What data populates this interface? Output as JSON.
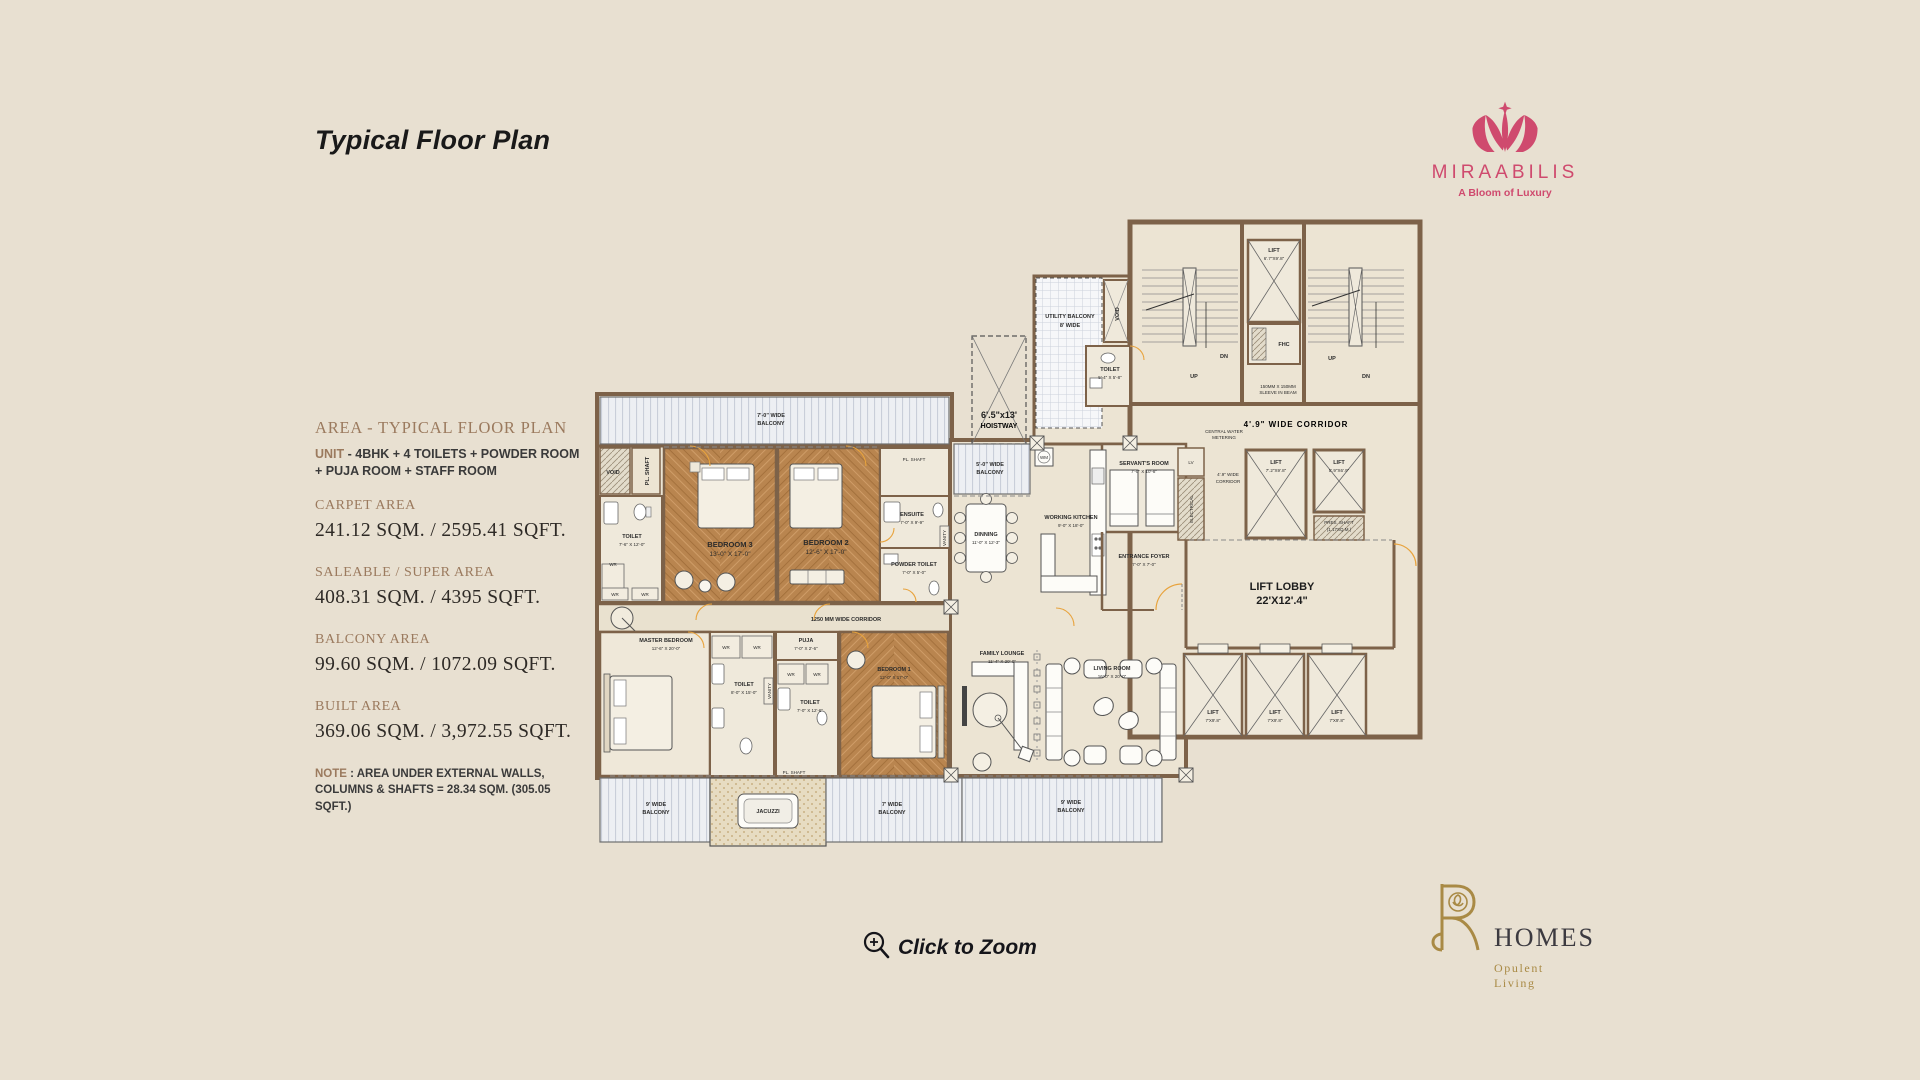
{
  "page": {
    "title": "Typical Floor Plan",
    "zoom_label": "Click to Zoom"
  },
  "brand_top": {
    "name": "MIRAABILIS",
    "tagline": "A Bloom of Luxury",
    "color": "#cf4a6e"
  },
  "brand_bottom": {
    "monogram": "PR",
    "name": "HOMES",
    "tagline": "Opulent Living",
    "gold": "#a98a45"
  },
  "icons": {
    "zoom": "magnifier-plus-icon",
    "flower_mark": "miraabilis-flower-icon",
    "monogram": "pr-rose-monogram-icon"
  },
  "area_panel": {
    "heading": "AREA - TYPICAL FLOOR PLAN",
    "unit_label": "UNIT",
    "unit_line1": " - 4BHK + 4 TOILETS + POWDER ROOM",
    "unit_line2": "+ PUJA ROOM + STAFF ROOM",
    "items": [
      {
        "label": "CARPET AREA",
        "value": "241.12 SQM. / 2595.41 SQFT."
      },
      {
        "label": "SALEABLE / SUPER AREA",
        "value": "408.31 SQM. / 4395 SQFT."
      },
      {
        "label": "BALCONY AREA",
        "value": "99.60 SQM. / 1072.09 SQFT."
      },
      {
        "label": "BUILT AREA",
        "value": "369.06 SQM. / 3,972.55 SQFT."
      }
    ],
    "note_label": "NOTE",
    "note_line1": " : AREA UNDER EXTERNAL WALLS,",
    "note_line2": "COLUMNS & SHAFTS = 28.34 SQM. (305.05 SQFT.)"
  },
  "plan": {
    "balcony_top_1": "7'-0\" WIDE",
    "balcony_top_2": "BALCONY",
    "hoistway_1": "6'.5\"x13'",
    "hoistway_2": "HOISTWAY",
    "utility_1": "UTILITY BALCONY",
    "utility_2": "8' WIDE",
    "void": "VOID",
    "pl_shaft": "PL. SHAFT",
    "toilet_sm_1": "TOILET",
    "toilet_sm_2": "5'-4\" X 5'-8\"",
    "balcony5_1": "5'-0\" WIDE",
    "balcony5_2": "BALCONY",
    "servants_1": "SERVANT'S ROOM",
    "servants_2": "7'-0\" X 10'-8\"",
    "wm": "WM",
    "kitchen_1": "WORKING KITCHEN",
    "kitchen_2": "9'-0\" X 18'-0\"",
    "dining_1": "DINNING",
    "dining_2": "11'-0\" X 12'-3\"",
    "entrance_1": "ENTRANCE FOYER",
    "entrance_2": "7'-0\" X 7'-0\"",
    "toilet3_1": "TOILET",
    "toilet3_2": "7'-6\" X 12'-0\"",
    "bedroom3_1": "BEDROOM 3",
    "bedroom3_2": "13'-0\" X 17'-0\"",
    "bedroom2_1": "BEDROOM 2",
    "bedroom2_2": "12'-6\" X 17'-0\"",
    "ensuite_1": "ENSUITE",
    "ensuite_2": "7'-0\" X 9'-9\"",
    "vanity": "VANITY",
    "powder_1": "POWDER TOILET",
    "powder_2": "7'-0\" X 5'-0\"",
    "corridor1250": "1250 MM WIDE CORRIDOR",
    "master_1": "MASTER BEDROOM",
    "master_2": "12'-6\" X 20'-0\"",
    "wr": "WR",
    "toilet_m_1": "TOILET",
    "toilet_m_2": "8'-0\" X 15'-0\"",
    "puja_1": "PUJA",
    "puja_2": "7'-0\" X 2'-6\"",
    "toilet1_1": "TOILET",
    "toilet1_2": "7'-0\" X 12'-6\"",
    "bedroom1_1": "BEDROOM 1",
    "bedroom1_2": "12'-0\" X 17'-0\"",
    "balcony9l_1": "9' WIDE",
    "balcony9l_2": "BALCONY",
    "jacuzzi": "JACUZZI",
    "balcony7b_1": "7' WIDE",
    "balcony7b_2": "BALCONY",
    "balcony9r_1": "9' WIDE",
    "balcony9r_2": "BALCONY",
    "family_1": "FAMILY LOUNGE",
    "family_2": "11'-4\" X 20'-0\"",
    "living_1": "LIVING ROOM",
    "living_2": "16'-0\" X 20'-0\"",
    "lift_top_1": "LIFT",
    "lift_top_2": "6'.7\"X9'.8\"",
    "fhc": "FHC",
    "up": "UP",
    "dn": "DN",
    "sleeve_1": "150MM X 150MM",
    "sleeve_2": "SLEEVE IN BEAM",
    "corridor49h": "4'.9\" WIDE CORRIDOR",
    "cwm_1": "CENTRAL WATER",
    "cwm_2": "METERING",
    "lv": "LV",
    "electrical": "ELECTRICAL",
    "corridor49v_1": "4'.9\" WIDE",
    "corridor49v_2": "CORRIDOR",
    "lifta_1": "LIFT",
    "lifta_2": "7'.2\"X9'.8\"",
    "liftb_1": "LIFT",
    "liftb_2": "5'.9\"X6'.9\"",
    "pres_1": "PRES. SHAFT",
    "pres_2": "(1.17SQ.M.)",
    "lobby_1": "LIFT LOBBY",
    "lobby_2": "22'X12'.4\"",
    "lift_b_1": "LIFT",
    "lift_b_2": "7'X9'.8\""
  },
  "colors": {
    "background": "#e8e0d1",
    "wall": "#7d6249",
    "room": "#ece4d3",
    "wood": "#b9854f",
    "accent": "#e8a33d",
    "pink": "#cf4a6e",
    "gold": "#a98a45"
  }
}
